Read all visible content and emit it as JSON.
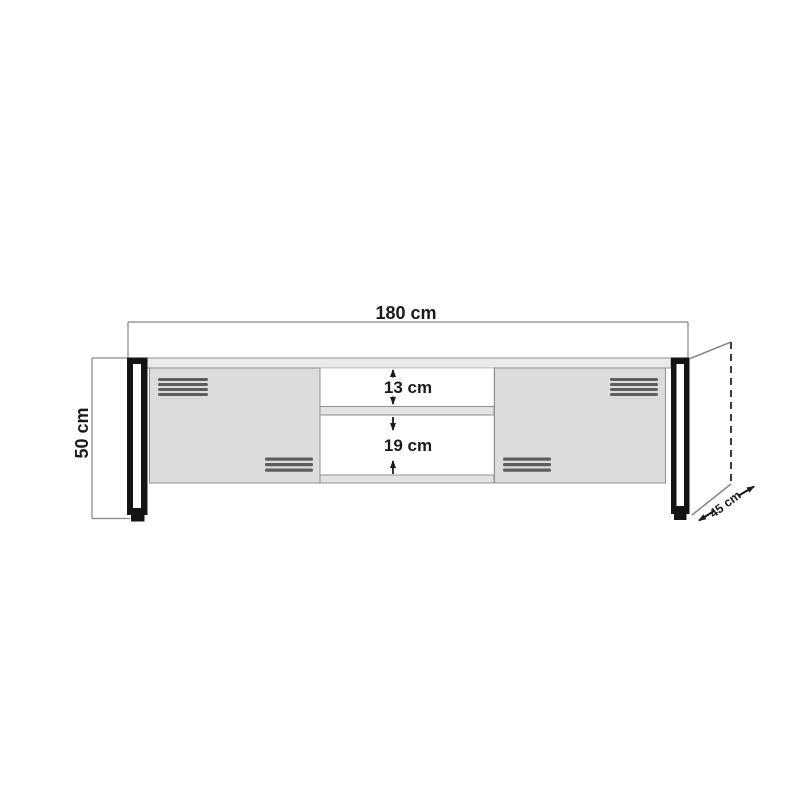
{
  "diagram": {
    "type": "furniture-dimension-drawing",
    "subject": "TV stand front elevation with depth perspective",
    "unit": "cm",
    "labels": {
      "width": "180 cm",
      "height": "50 cm",
      "depth": "45 cm",
      "upper_opening": "13 cm",
      "lower_opening": "19 cm"
    },
    "values": {
      "width_cm": 180,
      "height_cm": 50,
      "depth_cm": 45,
      "upper_opening_cm": 13,
      "lower_opening_cm": 19
    },
    "colors": {
      "background": "#ffffff",
      "outline": "#878787",
      "text": "#1a1a1a",
      "door_fill": "#dcdcdc",
      "panel_fill": "#eaeaea",
      "shelf_fill": "#e3e3e3",
      "leg": "#141414",
      "vent_bar": "#5e5e5e",
      "dashed_line": "#3b3b3b"
    }
  }
}
